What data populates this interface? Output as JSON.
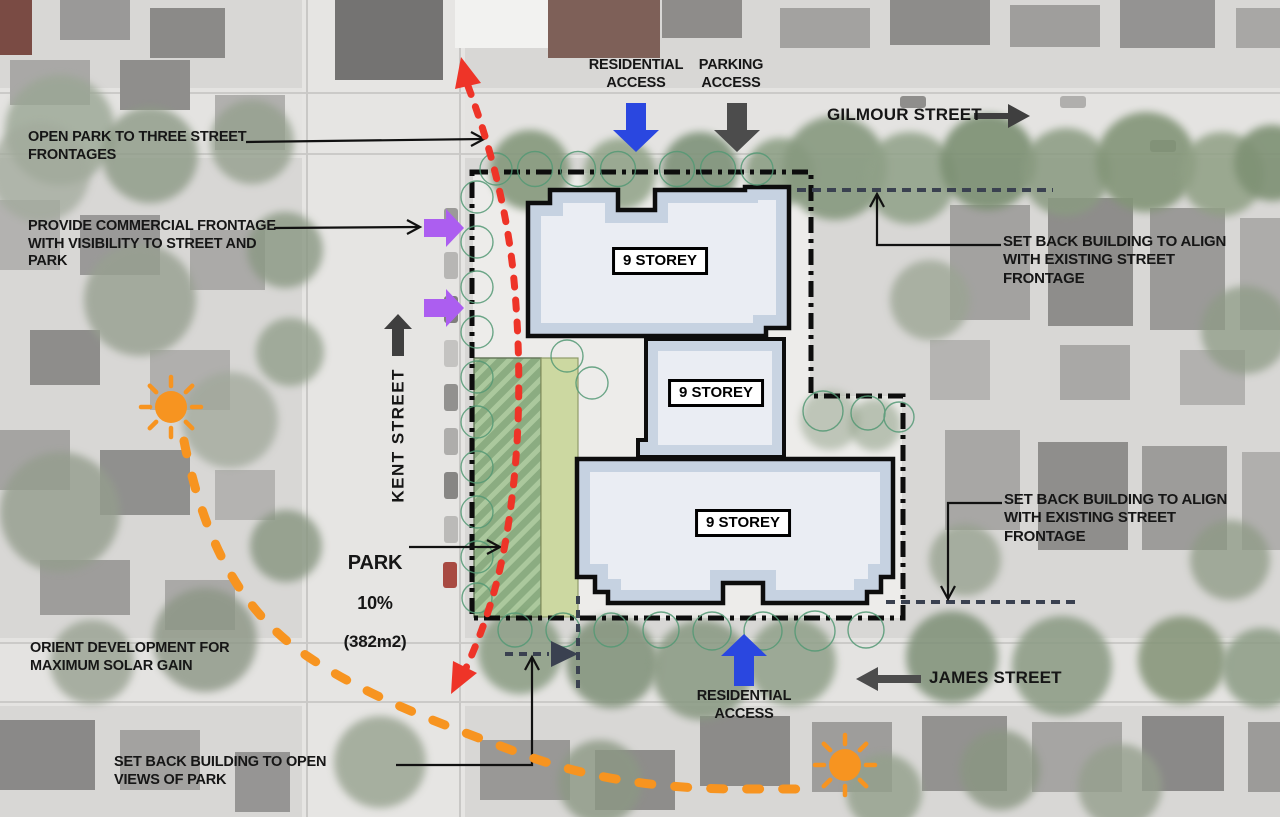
{
  "title": "Development site plan concept diagram",
  "streets": {
    "gilmour": "GILMOUR STREET",
    "kent": "KENT STREET",
    "james": "JAMES STREET"
  },
  "access": {
    "residential": "RESIDENTIAL\nACCESS",
    "parking": "PARKING\nACCESS"
  },
  "annotations": {
    "open_park": "OPEN PARK TO THREE STREET\nFRONTAGES",
    "commercial_frontage": "PROVIDE COMMERCIAL FRONTAGE\nWITH VISIBILITY TO STREET AND\nPARK",
    "setback_align": "SET BACK BUILDING TO ALIGN\nWITH EXISTING STREET\nFRONTAGE",
    "orient_solar": "ORIENT DEVELOPMENT FOR\nMAXIMUM SOLAR GAIN",
    "setback_views": "SET BACK BUILDING TO OPEN\nVIEWS OF PARK"
  },
  "park": {
    "title": "PARK",
    "percent": "10%",
    "area": "(382m2)"
  },
  "buildings": [
    {
      "label": "9 STOREY"
    },
    {
      "label": "9 STOREY"
    },
    {
      "label": "9 STOREY"
    }
  ],
  "colors": {
    "residential_access": "#2A47E0",
    "parking_access": "#4C4C4C",
    "commercial_frontage": "#AC5EF0",
    "solar_path": "#F79420",
    "park_connection": "#EE3428",
    "setback_line": "#3A4150"
  }
}
